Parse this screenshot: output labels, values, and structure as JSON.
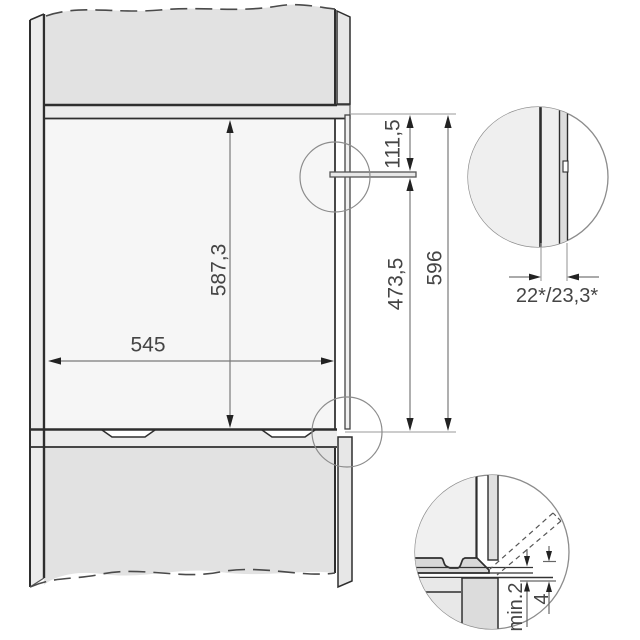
{
  "diagram": {
    "title": "built-in appliance niche installation drawing",
    "main": {
      "niche_width": "545",
      "niche_height": "587,3",
      "panel_top_offset": "111,5",
      "lower_section_height": "473,5",
      "front_total_height": "596"
    },
    "detail_top": {
      "depth_gap": "22*/23,3*"
    },
    "detail_bottom": {
      "min_clearance": "min.2",
      "clearance": "4"
    },
    "colors": {
      "panel_gray": "#e2e2e2",
      "board_gray": "#ececec",
      "strip_gray": "#e7e7e7",
      "detail_fill": "#efefef",
      "outline_dark": "#2e2e2e",
      "dim_line": "#7a7a7a",
      "dim_text": "#454545"
    }
  }
}
